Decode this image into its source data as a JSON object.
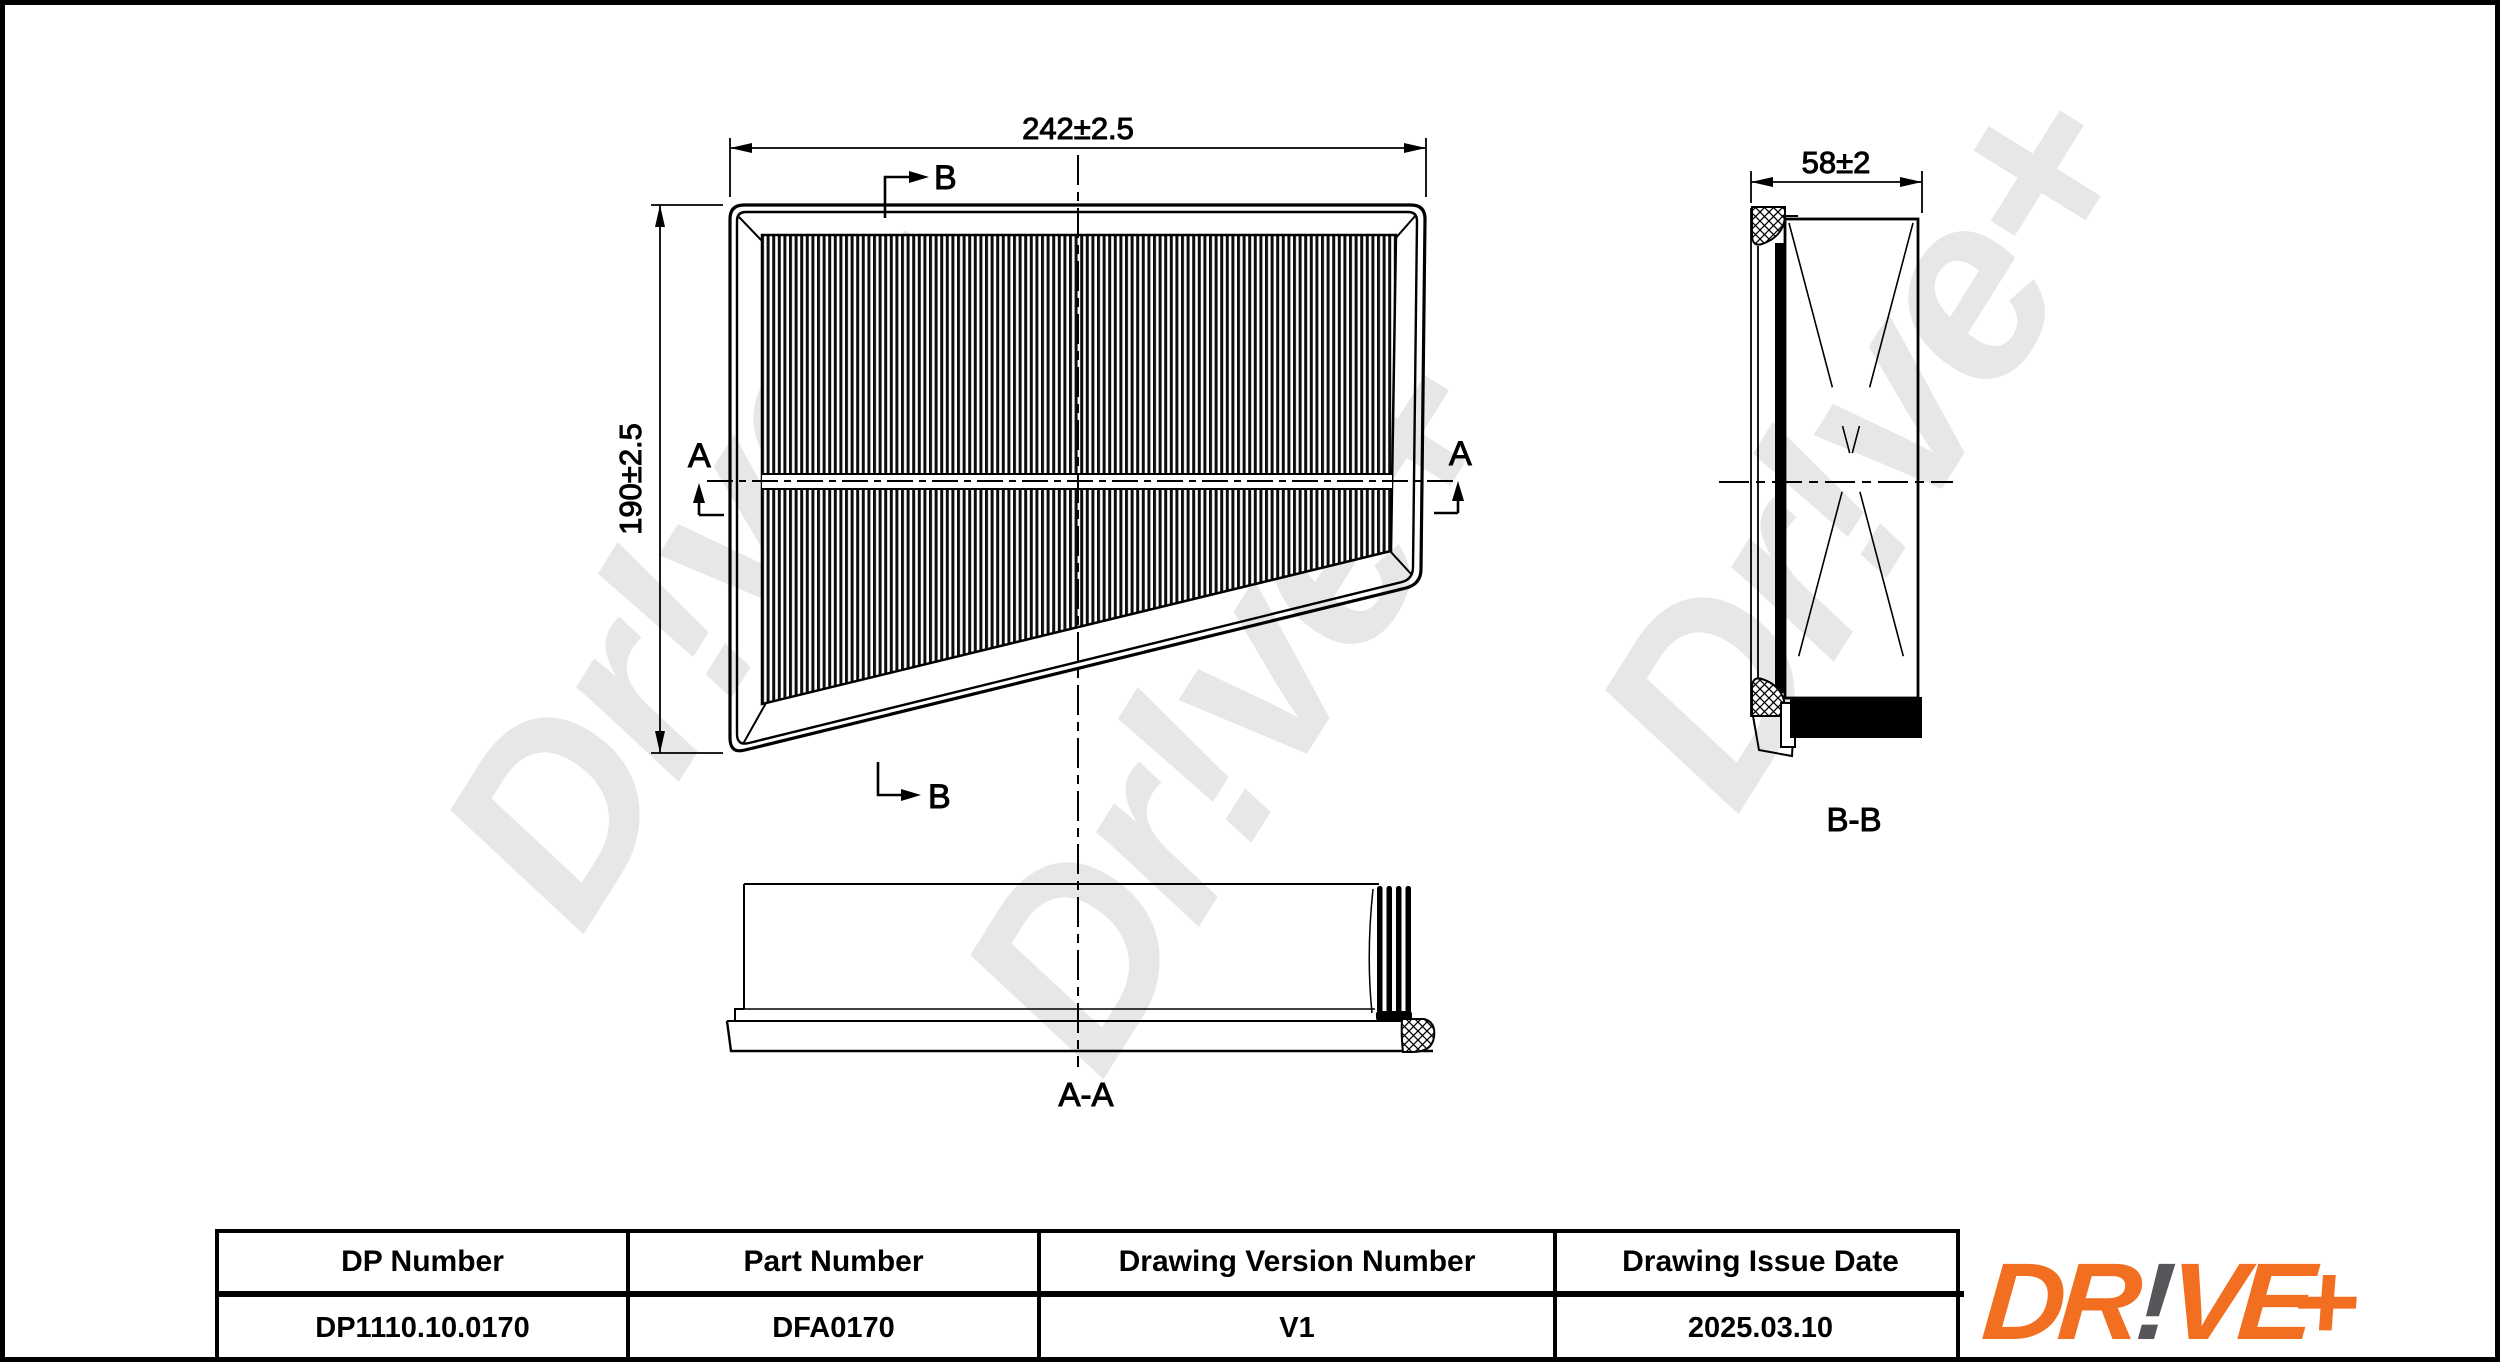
{
  "front_view": {
    "dim_width": "242±2.5",
    "dim_height": "190±2.5",
    "section_a": "A",
    "section_b": "B"
  },
  "section_views": {
    "bb_dim": "58±2",
    "bb_label": "B-B",
    "aa_label": "A-A"
  },
  "title_block": {
    "headers": [
      "DP Number",
      "Part Number",
      "Drawing Version Number",
      "Drawing Issue Date"
    ],
    "values": [
      "DP1110.10.0170",
      "DFA0170",
      "V1",
      "2025.03.10"
    ]
  },
  "logo": {
    "dr": "DR",
    "bang": "!",
    "ve": "VE",
    "plus": "+"
  },
  "watermark": {
    "text": "Dr!ve+",
    "color": "#e7e7e7"
  },
  "colors": {
    "line": "#000000",
    "logo_orange": "#F26F21",
    "logo_gray": "#55575A",
    "background": "#ffffff"
  }
}
